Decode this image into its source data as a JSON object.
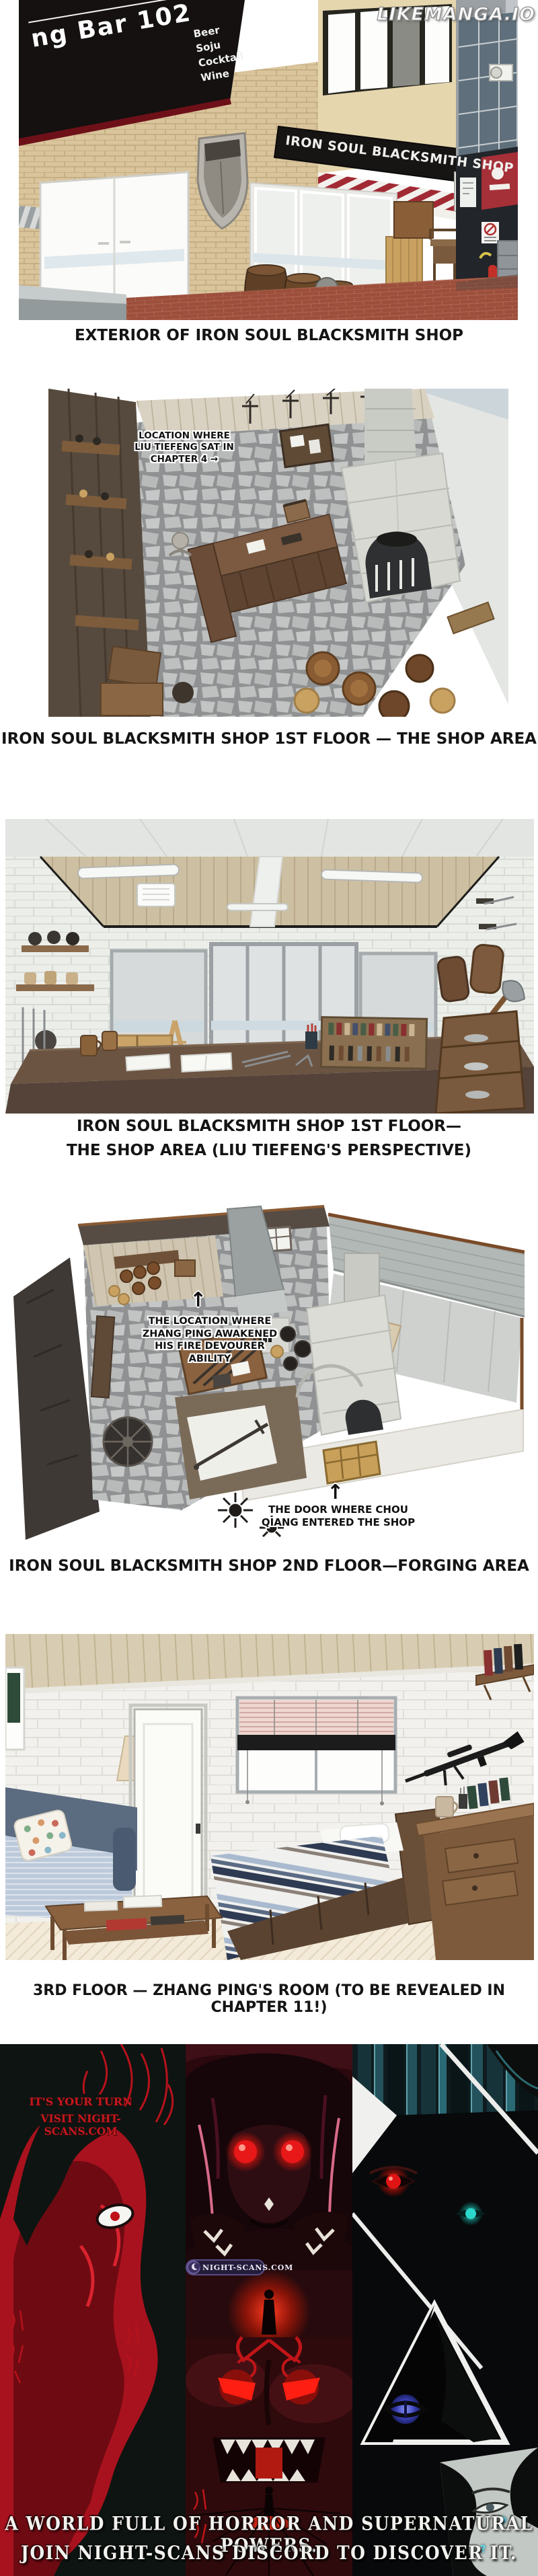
{
  "watermark": "LIKEMANGA.IO",
  "scene_exterior": {
    "caption": "EXTERIOR OF IRON SOUL BLACKSMITH SHOP",
    "bar_sign": {
      "top_fragment": "ar",
      "main": "ng Bar 102",
      "items": [
        "Beer",
        "Soju",
        "Cocktail",
        "Wine"
      ]
    },
    "shop_sign": "IRON SOUL BLACKSMITH SHOP"
  },
  "scene_floor1_top": {
    "caption": "IRON SOUL BLACKSMITH SHOP 1ST FLOOR — THE SHOP AREA",
    "label_lines": [
      "LOCATION WHERE",
      "LIU TIEFENG SAT IN",
      "CHAPTER 4 →"
    ]
  },
  "scene_floor1_pov": {
    "caption_line1": "IRON SOUL BLACKSMITH SHOP 1ST FLOOR—",
    "caption_line2": "THE SHOP AREA (LIU TIEFENG'S PERSPECTIVE)"
  },
  "scene_floor2": {
    "caption": "IRON SOUL BLACKSMITH SHOP 2ND FLOOR—FORGING AREA",
    "awaken_label": {
      "arrow": "↑",
      "lines": [
        "THE LOCATION WHERE",
        "ZHANG PING AWAKENED",
        "HIS FIRE DEVOURER",
        "ABILITY"
      ]
    },
    "door_label": {
      "arrow": "↑",
      "lines": [
        "THE DOOR WHERE CHOU",
        "QIANG ENTERED THE SHOP"
      ]
    }
  },
  "scene_floor3": {
    "caption": "3RD FLOOR — ZHANG PING'S ROOM (TO BE REVEALED IN CHAPTER 11!)"
  },
  "promo": {
    "tagline_line1": "IT'S YOUR TURN",
    "tagline_line2": "VISIT NIGHT-SCANS.COM",
    "badge_text": "NIGHT-SCANS.COM",
    "footer_line1": "A WORLD FULL OF HORROR AND SUPERNATURAL POWERS.",
    "footer_line2": "JOIN NIGHT-SCANS DISCORD TO DISCOVER IT.",
    "sfx_glyphs": [
      "?",
      "?"
    ]
  },
  "colors": {
    "caption_text": "#141414",
    "promo_red": "#c4181f",
    "badge_purple": "#241d3a",
    "glow_red": "#e81818",
    "glow_cyan": "#2ad8cc",
    "pavement_red": "#9c4f3c"
  }
}
